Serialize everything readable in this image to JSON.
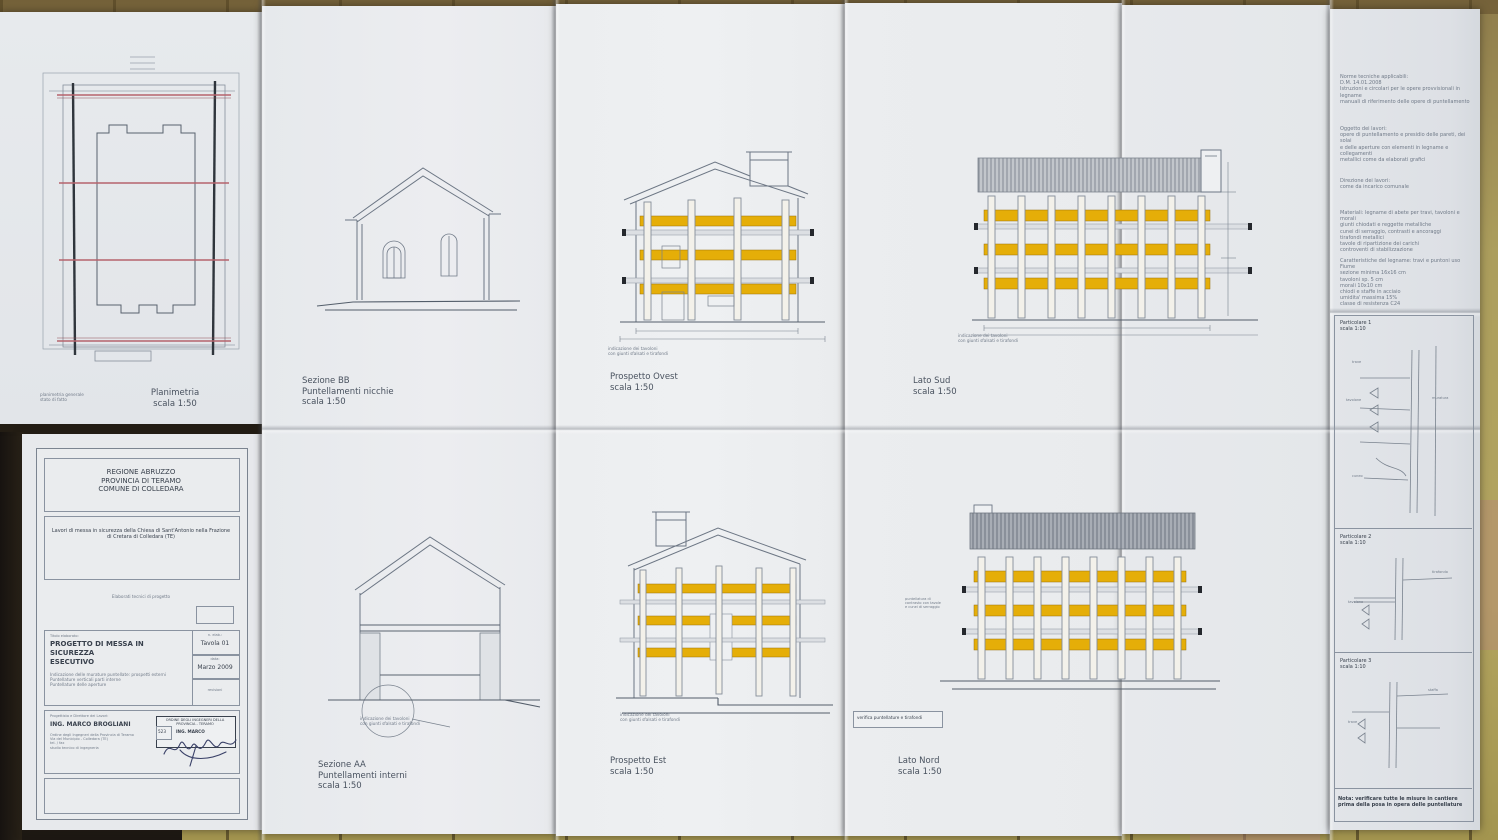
{
  "sheet": {
    "panels": {
      "planimetria": {
        "label": "Planimetria\nscala 1:50"
      },
      "sezione_bb": {
        "label": "Sezione BB\nPuntellamenti nicchie\nscala 1:50"
      },
      "sezione_aa": {
        "label": "Sezione AA\nPuntellamenti interni\nscala 1:50"
      },
      "prospetto_ovest": {
        "label": "Prospetto Ovest\nscala 1:50"
      },
      "prospetto_est": {
        "label": "Prospetto Est\nscala 1:50"
      },
      "lato_sud": {
        "label": "Lato Sud\nscala 1:50"
      },
      "lato_nord": {
        "label": "Lato Nord\nscala 1:50"
      }
    },
    "captions": {
      "tavoloni": "indicazione dei tavoloni\ncon giunti sfalsati e tirafondi",
      "plan_note": "planimetria generale\nstato di fatto",
      "lato_nord_note": "puntellatura di\ncontrasto con tavole\ne cunei di serraggio",
      "stamp_strip": "verifica puntellature e tirafondi"
    },
    "title_block": {
      "header_lines": "REGIONE ABRUZZO\nPROVINCIA DI TERAMO\nCOMUNE DI COLLEDARA",
      "project": "Lavori di messa in sicurezza della Chiesa di Sant'Antonio nella Frazione\ndi Cretara di Colledara (TE)",
      "middle_note": "Elaborati tecnici di progetto",
      "doc_title_label": "Titolo elaborato:",
      "doc_title": "PROGETTO DI MESSA IN SICUREZZA",
      "doc_subtitle": "ESECUTIVO",
      "doc_lines": "Indicazione delle murature puntellate: prospetti esterni\nPuntellature verticali parti interne\nPuntellature delle aperture",
      "tav_label": "n. elab.:",
      "tav_value": "Tavola 01",
      "date_label": "data:",
      "date_value": "Marzo 2009",
      "rev_label": "revisioni",
      "designer_label": "Progettista e Direttore dei Lavori:",
      "designer_name": "ING. MARCO BROGLIANI",
      "designer_info": "Ordine degli Ingegneri della Provincia di Teramo\nVia del Municipio - Colledara (TE)\ntel. / fax\nstudio tecnico di ingegneria",
      "stamp_header": "ORDINE DEGLI INGEGNERI DELLA PROVINCIA - TERAMO",
      "stamp_number": "523",
      "stamp_name": "ING. MARCO"
    },
    "right_column": {
      "notes": [
        "Norme tecniche applicabili:\nD.M. 14.01.2008\nIstruzioni e circolari per le opere provvisionali in legname\nmanuali di riferimento delle opere di puntellamento",
        "Oggetto dei lavori:\nopere di puntellamento e presidio delle pareti, dei solai\ne delle aperture con elementi in legname e collegamenti\nmetallici come da elaborati grafici",
        "Direzione dei lavori:\ncome da incarico comunale",
        "Materiali: legname di abete per travi, tavoloni e morali\ngiunti chiodati e reggette metalliche\ncunei di serraggio, contrasti e ancoraggi\ntirafondi metallici\ntavole di ripartizione dei carichi\ncontroventi di stabilizzazione",
        "Caratteristiche del legname: travi e puntoni uso Fiume\nsezione minima 16x16 cm\ntavoloni sp. 5 cm\nmorali 10x10 cm\nchiodi e staffe in acciaio\numidita' massima 15%\nclasse di resistenza C24"
      ],
      "details": [
        {
          "label": "Particolare 1\nscala 1:10"
        },
        {
          "label": "Particolare 2\nscala 1:10"
        },
        {
          "label": "Particolare 3\nscala 1:10"
        }
      ],
      "part_labels": {
        "muratura": "muratura",
        "trave": "trave",
        "tavolone": "tavolone",
        "tirafondo": "tirafondo",
        "cuneo": "cuneo",
        "staffa": "staffa"
      },
      "footer": "Nota: verificare tutte le misure in cantiere\nprima della posa in opera delle puntellature"
    }
  }
}
